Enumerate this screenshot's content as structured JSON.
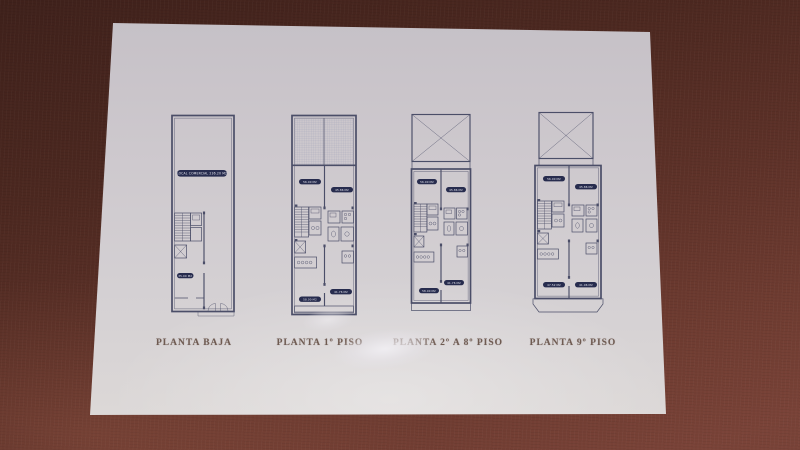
{
  "colors": {
    "fabric": "#6f3c31",
    "fabric_dark": "#3f211b",
    "paper": "#d4d0d3",
    "plan_line": "#4b4e68",
    "badge_bg": "#272c4e",
    "badge_text": "#e6e7f0",
    "title_text": "#6f5b52"
  },
  "plans": [
    {
      "title": "PLANTA BAJA",
      "badges": [
        {
          "position": "local",
          "label": "LOCAL COMERCIAL 236.20 M2"
        },
        {
          "position": "lower",
          "label": "35.00 M2"
        }
      ]
    },
    {
      "title": "PLANTA 1º PISO",
      "badges": [
        {
          "position": "top-left",
          "label": "56.00 M2"
        },
        {
          "position": "top-right",
          "label": "45.86 M2"
        },
        {
          "position": "bottom-right",
          "label": "41.76 M2"
        },
        {
          "position": "bottom-left",
          "label": "58.00 M2"
        }
      ]
    },
    {
      "title": "PLANTA 2º A 8º PISO",
      "badges": [
        {
          "position": "top-left",
          "label": "56.00 M2"
        },
        {
          "position": "top-right",
          "label": "45.86 M2"
        },
        {
          "position": "bottom-right",
          "label": "41.76 M2"
        },
        {
          "position": "bottom-left",
          "label": "58.00 M2"
        }
      ]
    },
    {
      "title": "PLANTA 9º PISO",
      "badges": [
        {
          "position": "top-left",
          "label": "56.00 M2"
        },
        {
          "position": "top-right",
          "label": "45.86 M2"
        },
        {
          "position": "bottom-left",
          "label": "47.52 M2"
        },
        {
          "position": "bottom-right",
          "label": "41.96 M2"
        }
      ]
    }
  ]
}
